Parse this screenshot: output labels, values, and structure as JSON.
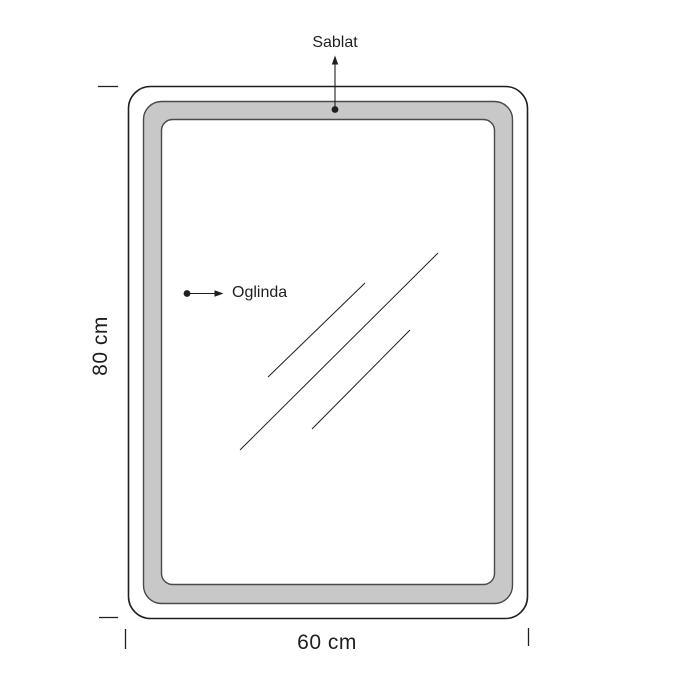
{
  "diagram": {
    "labels": {
      "sablat": "Sablat",
      "oglinda": "Oglinda",
      "height": "80 cm",
      "width": "60 cm"
    },
    "colors": {
      "background": "#ffffff",
      "line": "#1f1f1f",
      "band": "#c8c8c8",
      "band_edge": "#4a4a4a"
    }
  }
}
